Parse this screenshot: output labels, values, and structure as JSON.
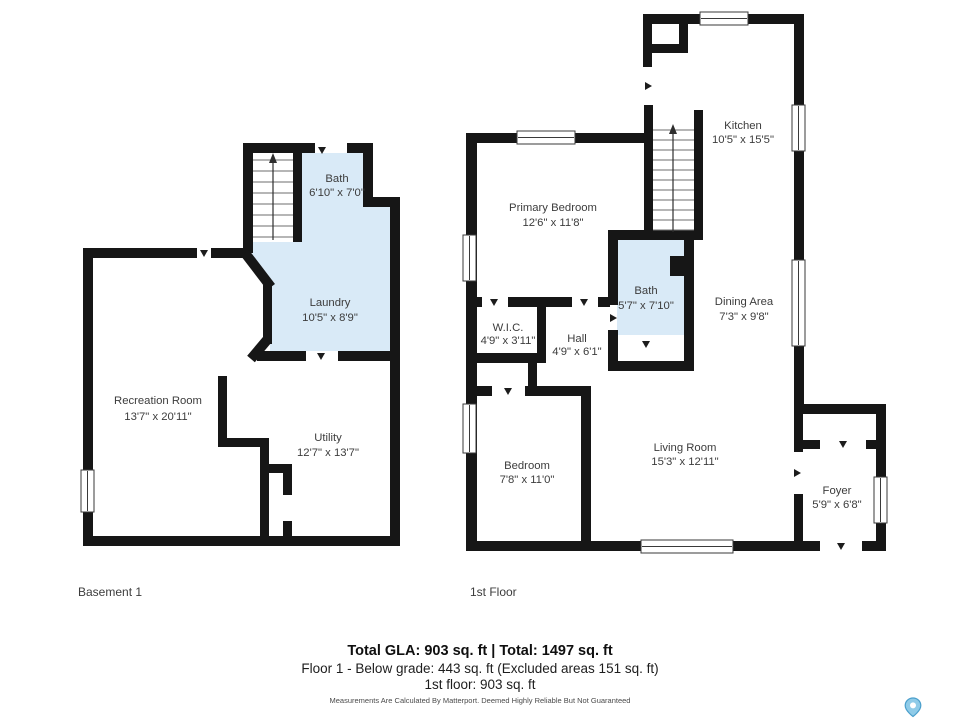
{
  "colors": {
    "wall": "#161616",
    "room_fill_blue": "#d9eaf7",
    "label_text": "#3c3c3c",
    "pin_blue": "#8fcbe8",
    "pin_outline": "#4a9fcc"
  },
  "icons": {
    "map_pin": "map-pin"
  },
  "floors": [
    {
      "title": "Basement 1",
      "rooms": [
        {
          "name": "Bath",
          "dims": "6'10\" x 7'0\""
        },
        {
          "name": "Laundry",
          "dims": "10'5\" x 8'9\""
        },
        {
          "name": "Recreation Room",
          "dims": "13'7\" x 20'11\""
        },
        {
          "name": "Utility",
          "dims": "12'7\" x 13'7\""
        }
      ]
    },
    {
      "title": "1st Floor",
      "rooms": [
        {
          "name": "Primary Bedroom",
          "dims": "12'6\" x 11'8\""
        },
        {
          "name": "Kitchen",
          "dims": "10'5\" x 15'5\""
        },
        {
          "name": "Bath",
          "dims": "5'7\" x 7'10\""
        },
        {
          "name": "Dining Area",
          "dims": "7'3\" x 9'8\""
        },
        {
          "name": "W.I.C.",
          "dims": "4'9\" x 3'11\""
        },
        {
          "name": "Hall",
          "dims": "4'9\" x 6'1\""
        },
        {
          "name": "Bedroom",
          "dims": "7'8\" x 11'0\""
        },
        {
          "name": "Living Room",
          "dims": "15'3\" x 12'11\""
        },
        {
          "name": "Foyer",
          "dims": "5'9\" x 6'8\""
        }
      ]
    }
  ],
  "footer": {
    "total_line": "Total GLA: 903 sq. ft | Total: 1497 sq. ft",
    "floor1_line": "Floor 1 - Below grade: 443 sq. ft (Excluded areas 151 sq. ft)",
    "first_floor_line": "1st floor: 903 sq. ft",
    "disclaimer": "Measurements Are Calculated By Matterport. Deemed Highly Reliable But Not Guaranteed"
  }
}
